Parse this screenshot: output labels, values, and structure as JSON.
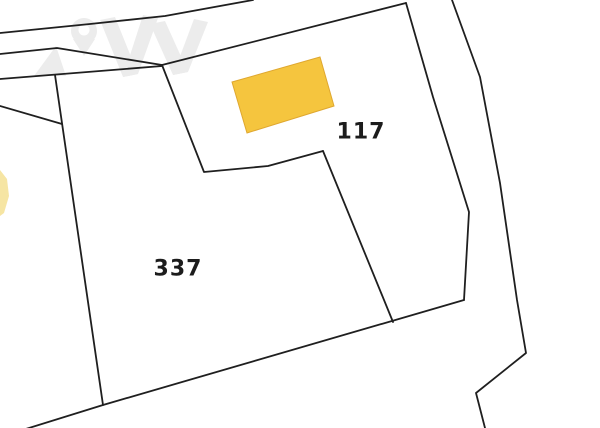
{
  "map": {
    "type": "cadastral-parcel-map",
    "background_color": "#ffffff",
    "boundary_color": "#1f1f1f",
    "boundary_width": 1.8,
    "building_fill": "#F5C53E",
    "building_stroke": "#DFA72F",
    "watermark_color": "#ECECEC",
    "labels": [
      {
        "text": "117",
        "x": 361,
        "y": 132
      },
      {
        "text": "337",
        "x": 178,
        "y": 269
      }
    ],
    "boundaries": [
      {
        "name": "road-upper-edge-top-left",
        "points": "0,33 90,24 165,16 253,0"
      },
      {
        "name": "road-lower-edge-top-left",
        "points": "0,54 57,48 162,65"
      },
      {
        "name": "parcel-337-north-edge",
        "points": "0,79 162,66"
      },
      {
        "name": "parcel-117-north-edge",
        "points": "162,65 406,3"
      },
      {
        "name": "parcel-337-117-upper-boundary",
        "points": "162,65 204,172 268,166 323,151"
      },
      {
        "name": "parcel-337-117-lower-boundary",
        "points": "323,151 393,322"
      },
      {
        "name": "parcel-337-west-boundary",
        "points": "55,75 103,405"
      },
      {
        "name": "parcel-south-boundary",
        "points": "0,437 103,405 464,300"
      },
      {
        "name": "road-west-edge-right",
        "points": "406,3 433,97 469,212 464,300"
      },
      {
        "name": "road-east-edge-right",
        "points": "452,0 480,77 500,183 517,300 526,353 476,393 485,428"
      },
      {
        "name": "left-edge-boundary-stub",
        "points": "0,106 62,124"
      }
    ],
    "buildings": [
      {
        "name": "building-parcel-117",
        "points": "232,82 320,57 334,106 247,133",
        "fill": "#F5C53E",
        "stroke": "#DFA72F",
        "opacity": 1
      },
      {
        "name": "building-clipped-left-edge",
        "points": "0,170 7,179 9,196 4,213 0,216",
        "fill": "#F4DF8C",
        "stroke": "none",
        "opacity": 0.8
      }
    ],
    "watermark": {
      "name": "map-pin-logo-watermark",
      "pin": {
        "cx": 84,
        "cy": 31,
        "r": 13,
        "tip": "73,39 95,39 84,56",
        "hole_r": 5.5
      },
      "shapes": [
        "34,76 56,46 66,76",
        "100,20 115,17 138,74 123,77",
        "123,77 138,74 158,18 143,15",
        "150,24 165,21 188,72 173,75",
        "173,75 188,72 208,22 194,19"
      ]
    }
  }
}
